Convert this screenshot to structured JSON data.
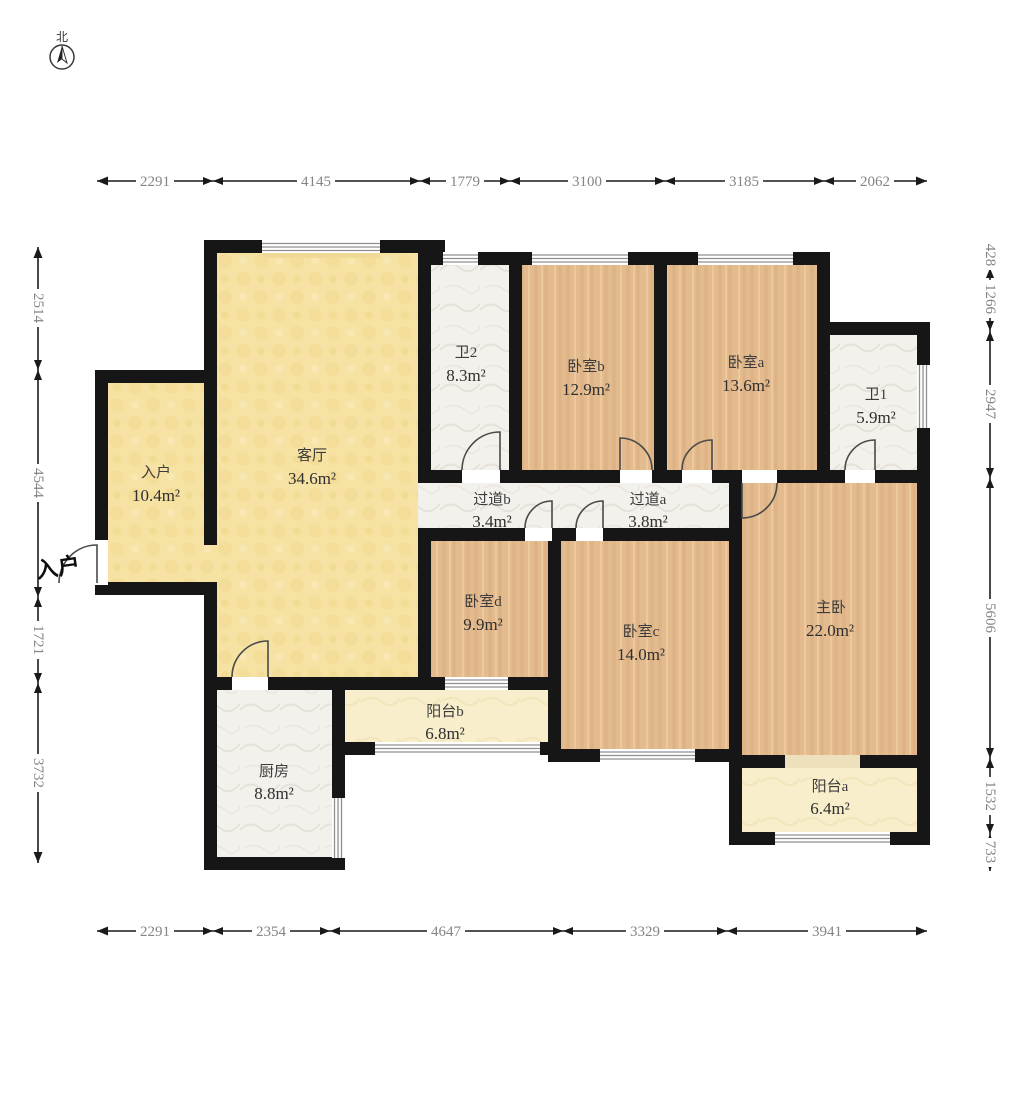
{
  "compass": {
    "label": "北"
  },
  "entrance_label": "入户",
  "rooms": [
    {
      "id": "entry",
      "name": "入户",
      "area": "10.4m²"
    },
    {
      "id": "living-room",
      "name": "客厅",
      "area": "34.6m²"
    },
    {
      "id": "bath-2",
      "name": "卫2",
      "area": "8.3m²"
    },
    {
      "id": "bedroom-b",
      "name": "卧室b",
      "area": "12.9m²"
    },
    {
      "id": "bedroom-a",
      "name": "卧室a",
      "area": "13.6m²"
    },
    {
      "id": "bath-1",
      "name": "卫1",
      "area": "5.9m²"
    },
    {
      "id": "hallway-b",
      "name": "过道b",
      "area": "3.4m²"
    },
    {
      "id": "hallway-a",
      "name": "过道a",
      "area": "3.8m²"
    },
    {
      "id": "bedroom-d",
      "name": "卧室d",
      "area": "9.9m²"
    },
    {
      "id": "bedroom-c",
      "name": "卧室c",
      "area": "14.0m²"
    },
    {
      "id": "master-bedroom",
      "name": "主卧",
      "area": "22.0m²"
    },
    {
      "id": "balcony-b",
      "name": "阳台b",
      "area": "6.8m²"
    },
    {
      "id": "kitchen",
      "name": "厨房",
      "area": "8.8m²"
    },
    {
      "id": "balcony-a",
      "name": "阳台a",
      "area": "6.4m²"
    }
  ],
  "dimensions": {
    "top": [
      "2291",
      "4145",
      "1779",
      "3100",
      "3185",
      "2062"
    ],
    "bottom": [
      "2291",
      "2354",
      "4647",
      "3329",
      "3941"
    ],
    "left": [
      "2514",
      "4544",
      "1721",
      "3732"
    ],
    "right": [
      "428",
      "1266",
      "2947",
      "5606",
      "1532",
      "733"
    ]
  },
  "colors": {
    "wall": "#161616",
    "yellow_floor": "#f6e2a3",
    "wood_floor": "#e3bb8e",
    "marble_floor": "#f3f1ec",
    "balcony_floor": "#f8eecb",
    "dim_text": "#848484"
  }
}
